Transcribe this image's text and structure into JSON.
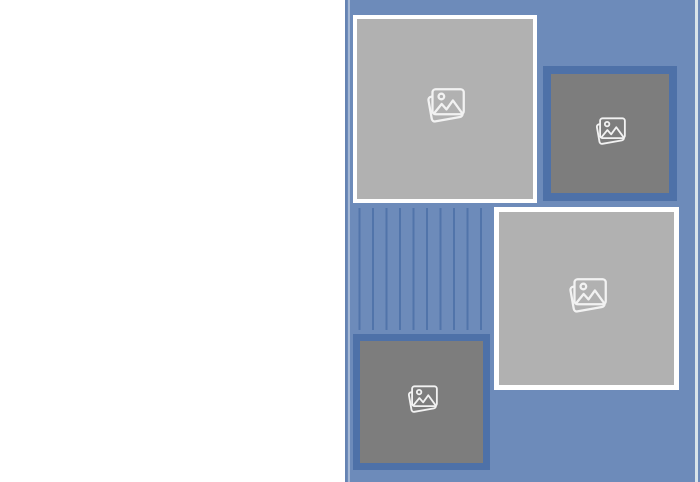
{
  "canvas": {
    "width": 700,
    "height": 482
  },
  "colors": {
    "page_bg": "#ffffff",
    "panel_blue": "#6d8bba",
    "accent_dark_blue": "#4e71a8",
    "tile_light_gray": "#b1b1b1",
    "tile_dark_gray": "#7d7d7d",
    "tile_white_border": "#ffffff",
    "icon_stroke": "#f2f2f2",
    "edge_highlight": "#d9e4ea",
    "panel_edge_shade": "#5f7dab"
  },
  "page": {
    "left_half": "blank white",
    "right_half": "blue photo collage panel"
  },
  "tiles": [
    {
      "id": "image-placeholder-1",
      "variant": "light",
      "border": "white",
      "icon": "photo-stack-icon",
      "icon_size": "large"
    },
    {
      "id": "image-placeholder-2",
      "variant": "dark",
      "border": "dark-blue",
      "icon": "photo-stack-icon",
      "icon_size": "small"
    },
    {
      "id": "image-placeholder-3",
      "variant": "light",
      "border": "white",
      "icon": "photo-stack-icon",
      "icon_size": "large"
    },
    {
      "id": "image-placeholder-4",
      "variant": "dark",
      "border": "dark-blue",
      "icon": "photo-stack-icon",
      "icon_size": "small"
    }
  ],
  "stripes": {
    "count": 10,
    "orientation": "vertical",
    "color": "#4e71a8"
  }
}
